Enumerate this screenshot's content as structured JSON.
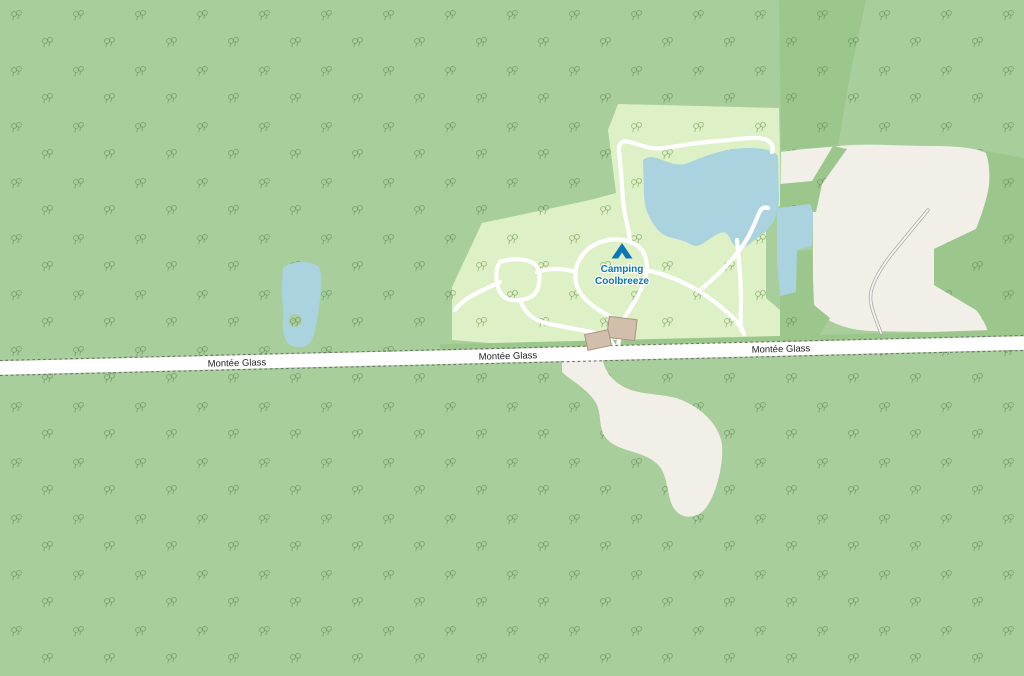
{
  "map": {
    "kind": "openstreetmap-style-tile",
    "road": {
      "name": "Montée Glass",
      "label_occurrences": 3
    },
    "poi": {
      "kind": "campsite",
      "icon": "tent-icon",
      "name_line1": "Camping",
      "name_line2": "Coolbreeze"
    },
    "features": {
      "large_lake": "lake inside campsite",
      "small_lake": "narrow pond east of campsite",
      "left_pond": "small pond with island west of campsite",
      "cleared_land": "bare/cleared land east and south of campsite",
      "buildings_count": 2
    },
    "colors": {
      "forest": "#A8CE9B",
      "forest_dark": "#9CC78C",
      "campsite": "#DEF0C5",
      "water": "#AAD3DF",
      "land": "#F2EFE9",
      "road_fill": "#FFFFFF",
      "road_casing": "#6E6E6E",
      "track": "#FFFFFF",
      "road_label": "#222222",
      "poi_label": "#0D77B5",
      "building_fill": "#D2BFAB",
      "building_stroke": "#A89480"
    }
  }
}
